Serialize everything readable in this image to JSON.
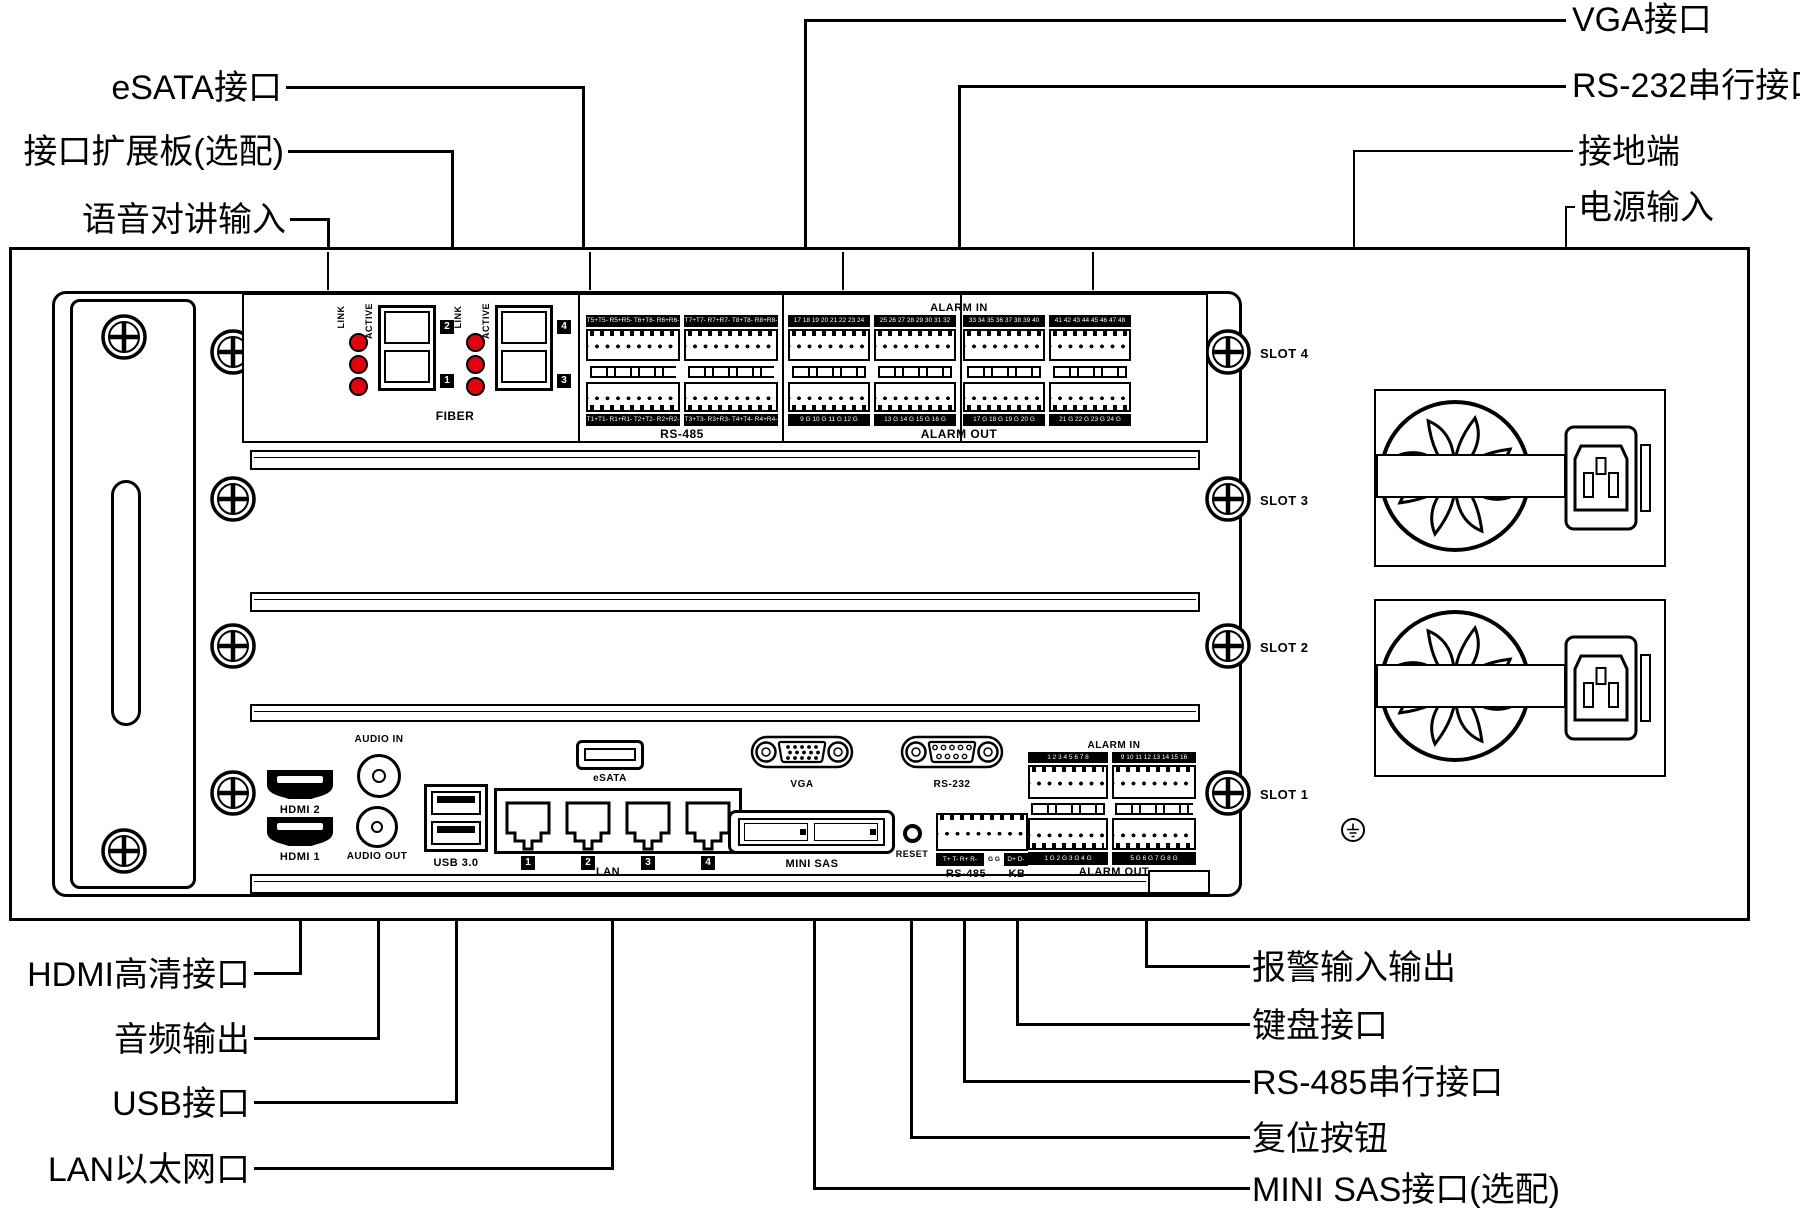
{
  "callouts": {
    "top_left": [
      "eSATA接口",
      "接口扩展板(选配)",
      "语音对讲输入"
    ],
    "top_right": [
      "VGA接口",
      "RS-232串行接口",
      "接地端",
      "电源输入"
    ],
    "bottom_left": [
      "HDMI高清接口",
      "音频输出",
      "USB接口",
      "LAN以太网口"
    ],
    "bottom_right": [
      "报警输入输出",
      "键盘接口",
      "RS-485串行接口",
      "复位按钮",
      "MINI SAS接口(选配)"
    ]
  },
  "expansion_board": {
    "link_label": "LINK",
    "active_label": "ACTIVE",
    "fiber_label": "FIBER",
    "port_badges": [
      "2",
      "1",
      "4",
      "3"
    ],
    "alarm_in_header": "ALARM IN",
    "rs485_label": "RS-485",
    "alarm_out_label": "ALARM OUT",
    "strips_top": [
      "T5+T5- R5+R5- T6+T6- R6+R6-",
      "T7+T7- R7+R7- T8+T8- R8+R8-",
      "17 18 19 20 21 22 23 24",
      "25 26 27 28 29 30 31 32",
      "33 34 35 36 37 38 39 40",
      "41 42 43 44 45 46 47 48"
    ],
    "strips_bottom": [
      "T1+T1- R1+R1- T2+T2- R2+R2-",
      "T3+T3- R3+R3- T4+T4- R4+R4-",
      "9 G 10 G 11 G 12 G",
      "13 G 14 G 15 G 16 G",
      "17 G 18 G 19 G 20 G",
      "21 G 22 G 23 G 24 G"
    ]
  },
  "slot_labels": [
    "SLOT 4",
    "SLOT 3",
    "SLOT 2",
    "SLOT 1"
  ],
  "rear_ports": {
    "audio_in": "AUDIO IN",
    "audio_out": "AUDIO OUT",
    "hdmi2": "HDMI 2",
    "hdmi1": "HDMI 1",
    "usb": "USB 3.0",
    "lan": "LAN",
    "lan_port_numbers": [
      "1",
      "2",
      "3",
      "4"
    ],
    "esata": "eSATA",
    "vga": "VGA",
    "rs232": "RS-232",
    "mini_sas": "MINI SAS",
    "reset": "RESET",
    "rs485_strip": [
      "T+ T- R+ R-",
      "G G",
      "D+ D-"
    ],
    "rs485_label": "RS-485",
    "kb_label": "KB",
    "alarm_in_header": "ALARM IN",
    "alarm_in_strips": [
      "1 2 3 4 5 6 7 8",
      "9 10 11 12 13 14 15 16"
    ],
    "alarm_out_strips": [
      "1 G 2 G 3 G 4 G",
      "5 G 6 G 7 G 8 G"
    ],
    "alarm_out_label": "ALARM OUT"
  },
  "colors": {
    "led_red": "#e3000f",
    "line": "#000000",
    "background": "#ffffff"
  }
}
